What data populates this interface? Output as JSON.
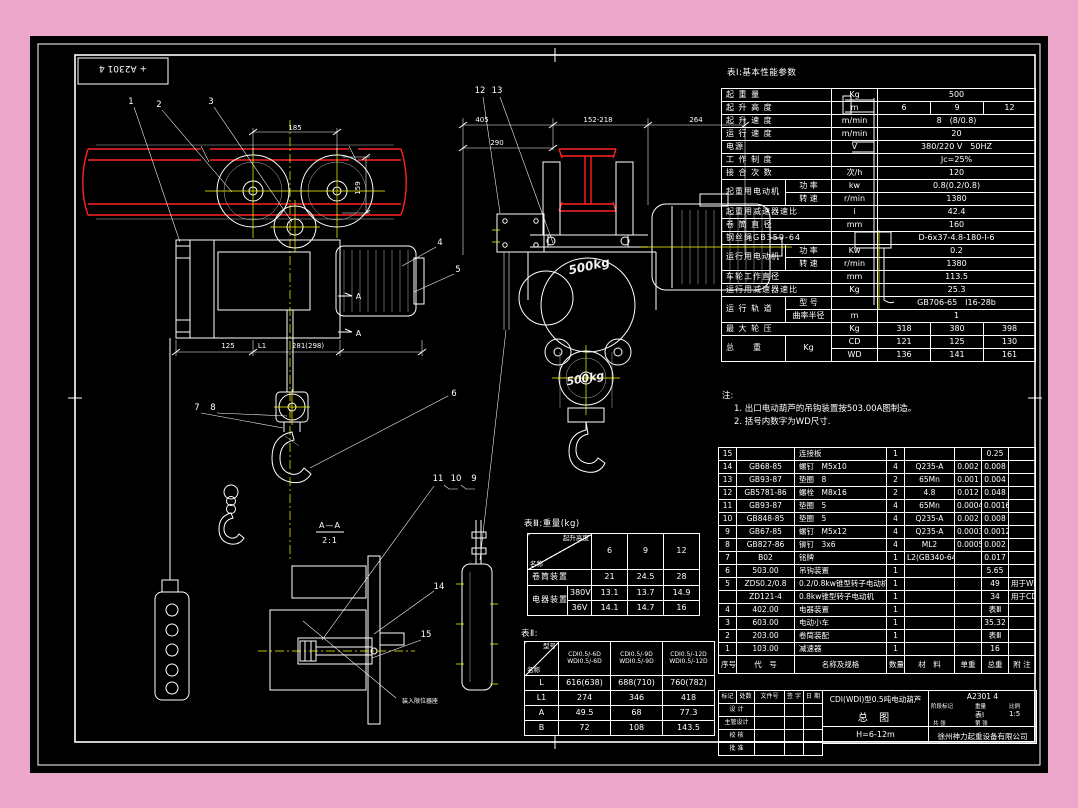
{
  "colors": {
    "background": "#eba6c9",
    "ink": "#ffffff",
    "beam_red": "#ff2a2a",
    "centerline_yellow": "#ffff00"
  },
  "stamp": {
    "number": "+ A2301 4"
  },
  "table1": {
    "title": "表Ⅰ:基本性能参数",
    "r0": {
      "name": "起 重 量",
      "unit": "Kg",
      "v": "500"
    },
    "r1": {
      "name": "起 升 高 度",
      "unit": "m",
      "v1": "6",
      "v2": "9",
      "v3": "12"
    },
    "r2": {
      "name": "起 升 速 度",
      "unit": "m/min",
      "v": "8　(8/0.8)"
    },
    "r3": {
      "name": "运 行 速 度",
      "unit": "m/min",
      "v": "20"
    },
    "r4": {
      "name": "电源",
      "unit": "V",
      "v": "380/220 V　50HZ"
    },
    "r5": {
      "name": "工 作 制 度",
      "unit": "",
      "v": "Jc=25%"
    },
    "r6": {
      "name": "接 合 次 数",
      "unit": "次/h",
      "v": "120"
    },
    "r7": {
      "name": "起重用电动机",
      "sub1": "功 率",
      "unit1": "kw",
      "v1": "0.8(0.2/0.8)",
      "sub2": "转 速",
      "unit2": "r/min",
      "v2": "1380"
    },
    "r8": {
      "name": "起重用减速器速比",
      "unit": "i",
      "v": "42.4"
    },
    "r9": {
      "name": "卷 筒 直 径",
      "unit": "mm",
      "v": "160"
    },
    "r10": {
      "name": "钢丝绳GB359-64",
      "unit": "",
      "v": "D-6x37-4.8-180-Ⅰ-6"
    },
    "r11": {
      "name": "运行用电动机",
      "sub1": "功 率",
      "unit1": "Kw",
      "v1": "0.2",
      "sub2": "转 速",
      "unit2": "r/min",
      "v2": "1380"
    },
    "r12": {
      "name": "车轮工作直径",
      "unit": "mm",
      "v": "113.5"
    },
    "r13": {
      "name": "运行用减速器速比",
      "unit": "Kg",
      "v": "25.3"
    },
    "r14": {
      "name": "运 行 轨 道",
      "sub1": "型 号",
      "unit1": "",
      "v1": "GB706-65　Ⅰ16-28b",
      "sub2": "曲率半径",
      "unit2": "m",
      "v2": "1"
    },
    "r15": {
      "name": "最 大 轮 压",
      "unit": "Kg",
      "v1": "318",
      "v2": "380",
      "v3": "398"
    },
    "r16": {
      "name": "总　　重",
      "kg": "Kg",
      "cd": "CD",
      "cd1": "121",
      "cd2": "125",
      "cd3": "130",
      "wd": "WD",
      "wd1": "136",
      "wd2": "141",
      "wd3": "161"
    }
  },
  "notes": {
    "label": "注:",
    "line1": "1. 出口电动葫芦的吊钩装置按503.00A图制造。",
    "line2": "2. 括号内数字为WD尺寸."
  },
  "bom": {
    "head": {
      "no": "序号",
      "code": "代　号",
      "name": "名称及规格",
      "qty": "数量",
      "mat": "材　料",
      "w1": "单重",
      "w2": "总重",
      "note": "附 注"
    },
    "rows": [
      {
        "no": "15",
        "code": "",
        "name": "连接板",
        "qty": "1",
        "mat": "",
        "w1": "",
        "w2": "0.25",
        "note": ""
      },
      {
        "no": "14",
        "code": "GB68-85",
        "name": "螺钉　M5x10",
        "qty": "4",
        "mat": "Q235-A",
        "w1": "0.002",
        "w2": "0.008",
        "note": ""
      },
      {
        "no": "13",
        "code": "GB93-87",
        "name": "垫圈　8",
        "qty": "2",
        "mat": "65Mn",
        "w1": "0.001",
        "w2": "0.004",
        "note": ""
      },
      {
        "no": "12",
        "code": "GB5781-86",
        "name": "螺栓　M8x16",
        "qty": "2",
        "mat": "4.8",
        "w1": "0.012",
        "w2": "0.048",
        "note": ""
      },
      {
        "no": "11",
        "code": "GB93-87",
        "name": "垫圈　5",
        "qty": "4",
        "mat": "65Mn",
        "w1": "0.0004",
        "w2": "0.0016",
        "note": ""
      },
      {
        "no": "10",
        "code": "GB848-85",
        "name": "垫圈　5",
        "qty": "4",
        "mat": "Q235-A",
        "w1": "0.002",
        "w2": "0.008",
        "note": ""
      },
      {
        "no": "9",
        "code": "GB67-85",
        "name": "螺钉　M5x12",
        "qty": "4",
        "mat": "Q235-A",
        "w1": "0.0003",
        "w2": "0.0012",
        "note": ""
      },
      {
        "no": "8",
        "code": "GB827-86",
        "name": "铆钉　3x6",
        "qty": "4",
        "mat": "ML2",
        "w1": "0.0005",
        "w2": "0.002",
        "note": ""
      },
      {
        "no": "7",
        "code": "B02",
        "name": "铭牌",
        "qty": "1",
        "mat": "L2(GB340-64)",
        "w1": "",
        "w2": "0.017",
        "note": ""
      },
      {
        "no": "6",
        "code": "503.00",
        "name": "吊钩装置",
        "qty": "1",
        "mat": "",
        "w1": "",
        "w2": "5.65",
        "note": ""
      },
      {
        "no": "5",
        "code": "ZDS0.2/0.8",
        "name": "0.2/0.8kw锥型转子电动机",
        "qty": "1",
        "mat": "",
        "w1": "",
        "w2": "49",
        "note": "用于WD"
      },
      {
        "no": "",
        "code": "ZD121-4",
        "name": "0.8kw锥型转子电动机",
        "qty": "1",
        "mat": "",
        "w1": "",
        "w2": "34",
        "note": "用于CD"
      },
      {
        "no": "4",
        "code": "402.00",
        "name": "电器装置",
        "qty": "1",
        "mat": "",
        "w1": "",
        "w2": "表Ⅲ",
        "note": ""
      },
      {
        "no": "3",
        "code": "603.00",
        "name": "电动小车",
        "qty": "1",
        "mat": "",
        "w1": "",
        "w2": "35.32",
        "note": ""
      },
      {
        "no": "2",
        "code": "203.00",
        "name": "卷筒装配",
        "qty": "1",
        "mat": "",
        "w1": "",
        "w2": "表Ⅲ",
        "note": ""
      },
      {
        "no": "1",
        "code": "103.00",
        "name": "减速器",
        "qty": "1",
        "mat": "",
        "w1": "",
        "w2": "16",
        "note": ""
      }
    ]
  },
  "table3": {
    "title": "表Ⅲ:重量(kg)",
    "corner_top": "起升高度",
    "corner_bottom": "名称",
    "c1": "6",
    "c2": "9",
    "c3": "12",
    "row1": {
      "name": "卷筒装置",
      "v1": "21",
      "v2": "24.5",
      "v3": "28"
    },
    "row2": {
      "name": "电器装置",
      "sub": "380V",
      "v1": "13.1",
      "v2": "13.7",
      "v3": "14.9"
    },
    "row3": {
      "sub": "36V",
      "v1": "14.1",
      "v2": "14.7",
      "v3": "16"
    }
  },
  "table2": {
    "title": "表Ⅱ:",
    "corner_top": "型号",
    "corner_bottom": "名称",
    "c1a": "CDI0.5/-6D",
    "c1b": "WDI0.5/-6D",
    "c2a": "CDI0.5/-9D",
    "c2b": "WDI0.5/-9D",
    "c3a": "CDI0.5/-12D",
    "c3b": "WDI0.5/-12D",
    "row1": {
      "name": "L",
      "v1": "616(638)",
      "v2": "688(710)",
      "v3": "760(782)"
    },
    "row2": {
      "name": "L1",
      "v1": "274",
      "v2": "346",
      "v3": "418"
    },
    "row3": {
      "name": "A",
      "v1": "49.5",
      "v2": "68",
      "v3": "77.3"
    },
    "row4": {
      "name": "B",
      "v1": "72",
      "v2": "108",
      "v3": "143.5"
    }
  },
  "titleblock": {
    "head": {
      "c1": "标记",
      "c2": "处数",
      "c3": "文件号",
      "c4": "签 字",
      "c5": "日 期"
    },
    "fields": [
      "设 计",
      "主管设计",
      "校 核",
      "批 准"
    ],
    "title1": "CDⅠ(WDⅠ)型0.5吨电动葫芦",
    "title2": "总 图",
    "span": "H=6-12m",
    "number": "A2301 4",
    "meta": {
      "stage": "阶段标记",
      "weight": "重量",
      "scale": "比例",
      "weight_val": "表Ⅰ",
      "scale_val": "1:5",
      "sheet_total": "共 张",
      "sheet_no": "第 张"
    },
    "company": "徐州神力起重设备有限公司"
  },
  "drawing": {
    "balloons": {
      "b1": "1",
      "b2": "2",
      "b3": "3",
      "b4": "4",
      "b5": "5",
      "b6": "6",
      "b7": "7",
      "b8": "8",
      "b9": "9",
      "b10": "10",
      "b11": "11",
      "b12": "12",
      "b13": "13",
      "b14": "14",
      "b15": "15"
    },
    "dims": {
      "wheelbase": "185",
      "beam_height": "159",
      "d125": "125",
      "dL1": "L1",
      "d281": "281(298)",
      "d405": "405",
      "d152": "152-218",
      "d264": "264",
      "d290": "290"
    },
    "marks": {
      "cast_top": "500kg",
      "cast_bottom": "500kg",
      "section_label": "A—A",
      "section_scale": "2:1",
      "detail_note": "装入限位器座",
      "cut_label": "A"
    }
  }
}
